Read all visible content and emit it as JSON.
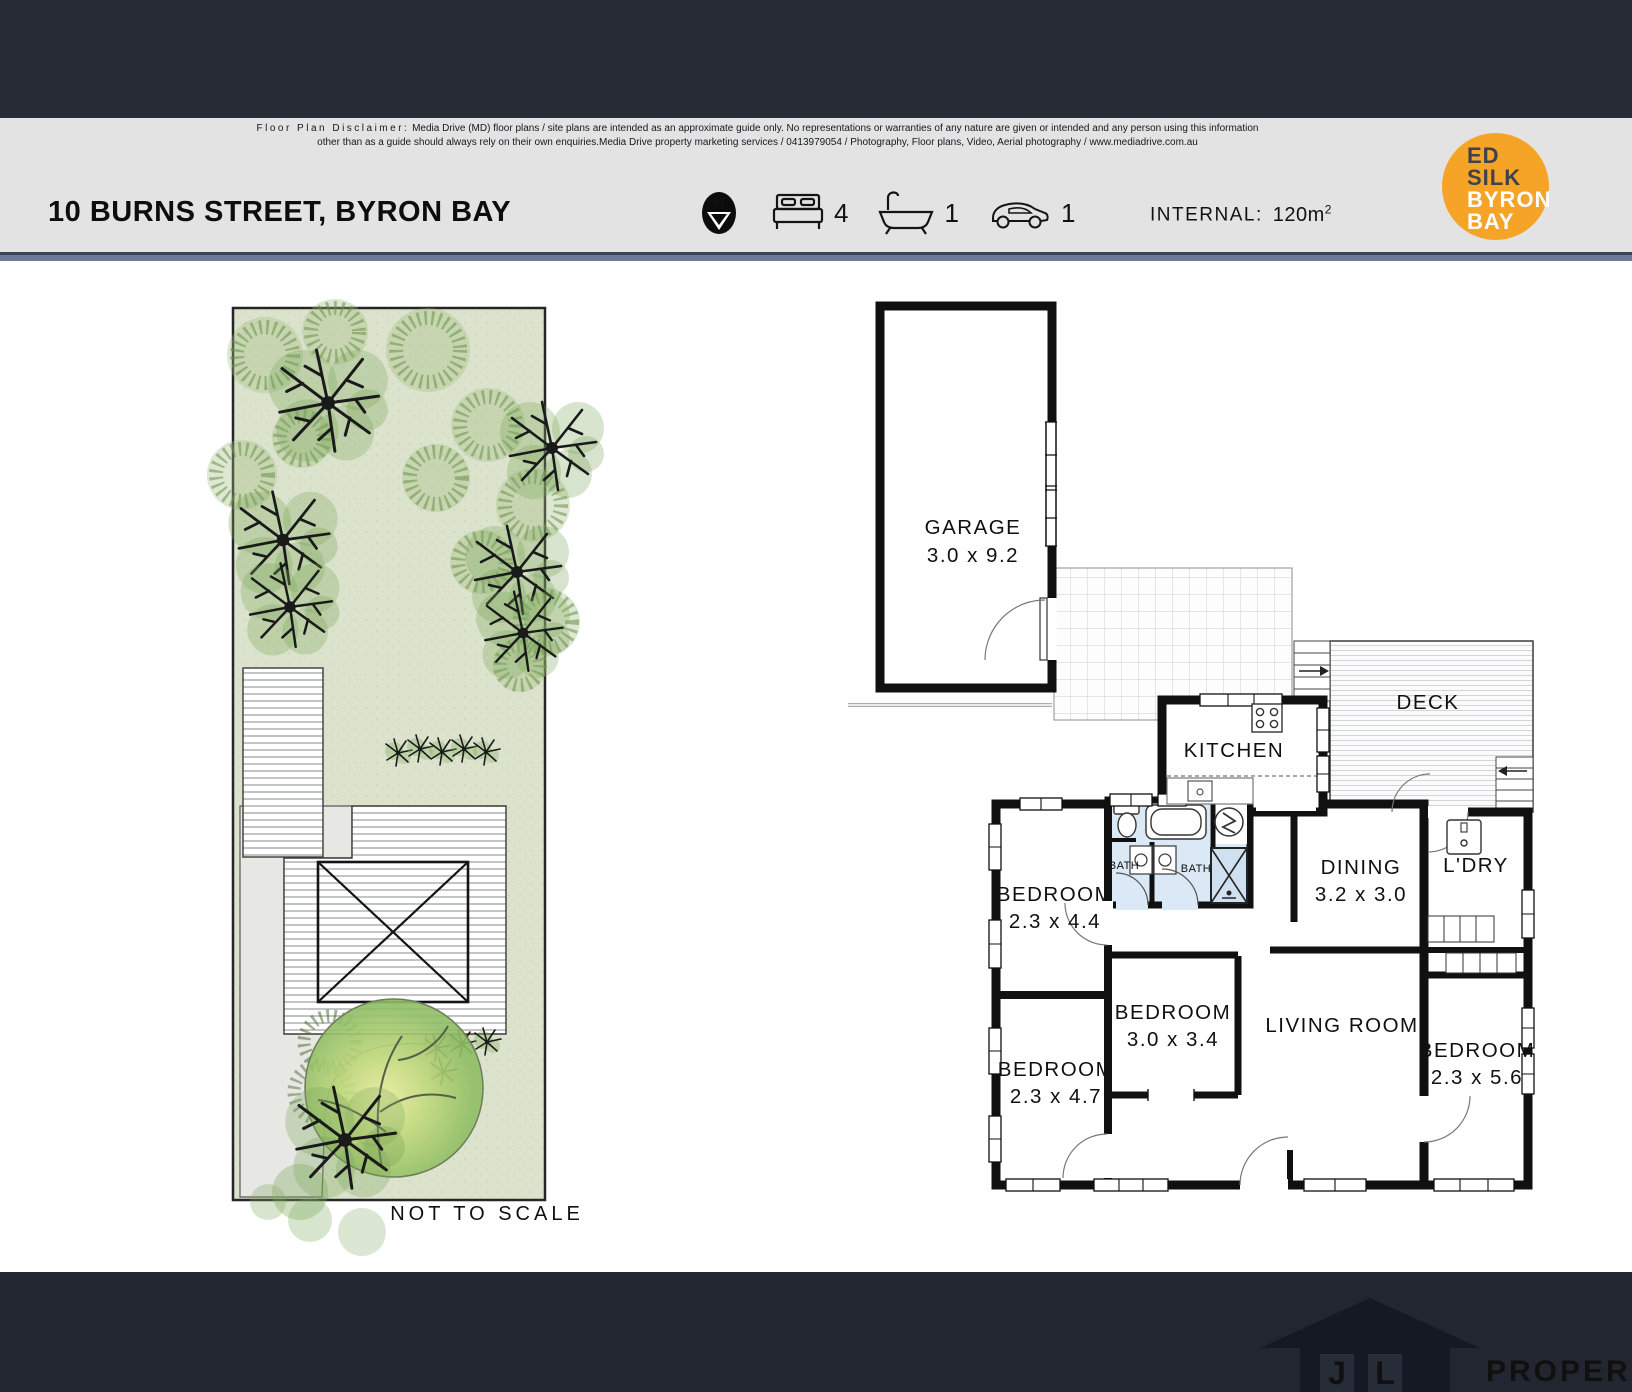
{
  "header": {
    "disclaimer": {
      "label": "Floor Plan Disclaimer:",
      "line1": "Media Drive (MD) floor plans / site plans are intended as an approximate guide only.  No representations or warranties of any nature are given or intended and any person using this information",
      "line2": "other than as a guide should always rely on their own enquiries.Media Drive property marketing services / 0413979054 / Photography, Floor plans,  Video, Aerial photography / www.mediadrive.com.au"
    },
    "address": "10 BURNS STREET, BYRON BAY",
    "stats": {
      "north_letter": "N",
      "beds": "4",
      "baths": "1",
      "cars": "1",
      "internal_label": "INTERNAL:",
      "internal_value": "120m",
      "internal_sup": "2"
    }
  },
  "logo": {
    "l1": "ED",
    "l2": "SILK",
    "l3": "BYRON",
    "l4": "BAY",
    "color": "#F5A427"
  },
  "site_plan": {
    "note": "NOT TO SCALE"
  },
  "floor_plan": {
    "garage_name": "GARAGE",
    "garage_dims": "3.0 x 9.2",
    "deck": "DECK",
    "kitchen": "KITCHEN",
    "bath_left": "BATH",
    "bath_right": "BATH",
    "dining_name": "DINING",
    "dining_dims": "3.2 x 3.0",
    "laundry": "L'DRY",
    "living": "LIVING ROOM",
    "bed1_name": "BEDROOM",
    "bed1_dims": "2.3 x 4.4",
    "bed2_name": "BEDROOM",
    "bed2_dims": "2.3 x 4.7",
    "bed3_name": "BEDROOM",
    "bed3_dims": "3.0 x 3.4",
    "bed4_name": "BEDROOM",
    "bed4_dims": "2.3 x 5.6"
  },
  "footer": {
    "brand_j": "J",
    "brand_l": "L",
    "brand_name": "PROPERTY"
  }
}
